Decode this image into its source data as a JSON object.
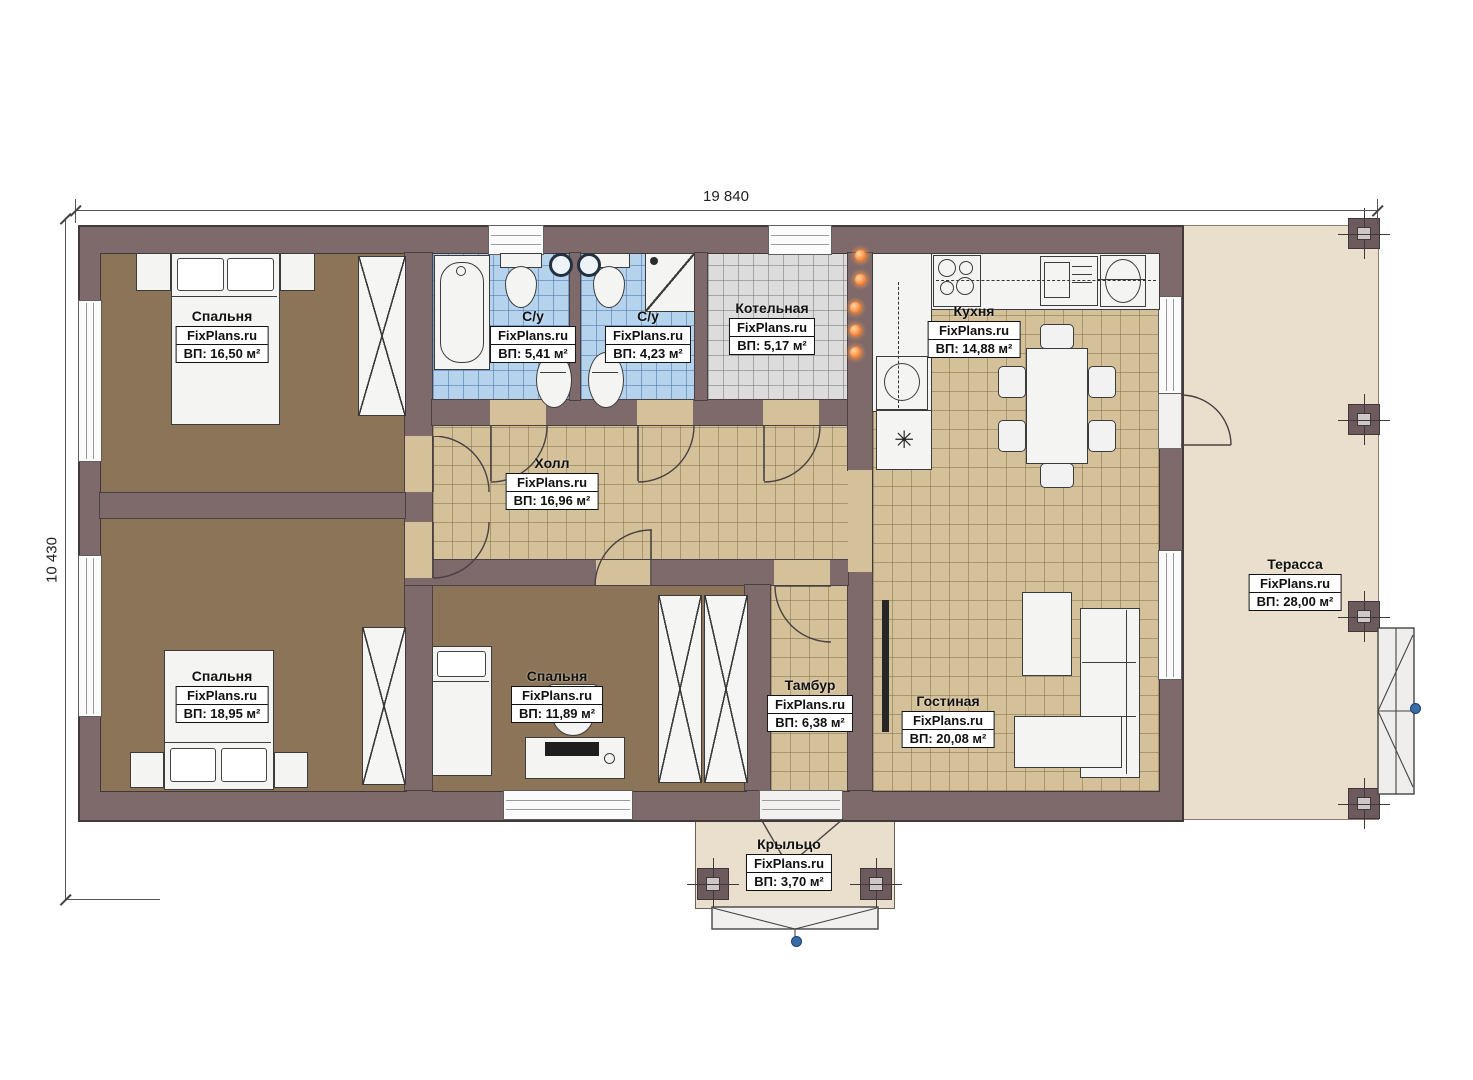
{
  "plan": {
    "brand": "FixPlans.ru",
    "dimensions": {
      "top": "19 840",
      "left": "10 430"
    },
    "symbols": {
      "freezer": "✳"
    },
    "colors": {
      "wall": "#7e696b",
      "bedroom_floor": "#8b7457",
      "tile_floor": "#d4c199",
      "bath_tile": "#b6d3ee",
      "boiler_tile": "#dcdcdc",
      "terrace": "#e9dfcc",
      "accent_orange": "#ff8a3c",
      "marker_blue": "#3a6ca8"
    },
    "rooms": [
      {
        "id": "bedroom-1",
        "name": "Спальня",
        "brand": "FixPlans.ru",
        "area": "ВП: 16,50 м²"
      },
      {
        "id": "wc-1",
        "name": "С/у",
        "brand": "FixPlans.ru",
        "area": "ВП: 5,41 м²"
      },
      {
        "id": "wc-2",
        "name": "С/у",
        "brand": "FixPlans.ru",
        "area": "ВП: 4,23 м²"
      },
      {
        "id": "boiler",
        "name": "Котельная",
        "brand": "FixPlans.ru",
        "area": "ВП: 5,17 м²"
      },
      {
        "id": "kitchen",
        "name": "Кухня",
        "brand": "FixPlans.ru",
        "area": "ВП: 14,88 м²"
      },
      {
        "id": "hall",
        "name": "Холл",
        "brand": "FixPlans.ru",
        "area": "ВП: 16,96 м²"
      },
      {
        "id": "bedroom-2",
        "name": "Спальня",
        "brand": "FixPlans.ru",
        "area": "ВП: 18,95 м²"
      },
      {
        "id": "bedroom-3",
        "name": "Спальня",
        "brand": "FixPlans.ru",
        "area": "ВП: 11,89 м²"
      },
      {
        "id": "tambour",
        "name": "Тамбур",
        "brand": "FixPlans.ru",
        "area": "ВП: 6,38 м²"
      },
      {
        "id": "living",
        "name": "Гостиная",
        "brand": "FixPlans.ru",
        "area": "ВП: 20,08 м²"
      },
      {
        "id": "terrace",
        "name": "Терасса",
        "brand": "FixPlans.ru",
        "area": "ВП: 28,00 м²"
      },
      {
        "id": "porch",
        "name": "Крыльцо",
        "brand": "FixPlans.ru",
        "area": "ВП: 3,70 м²"
      }
    ]
  }
}
